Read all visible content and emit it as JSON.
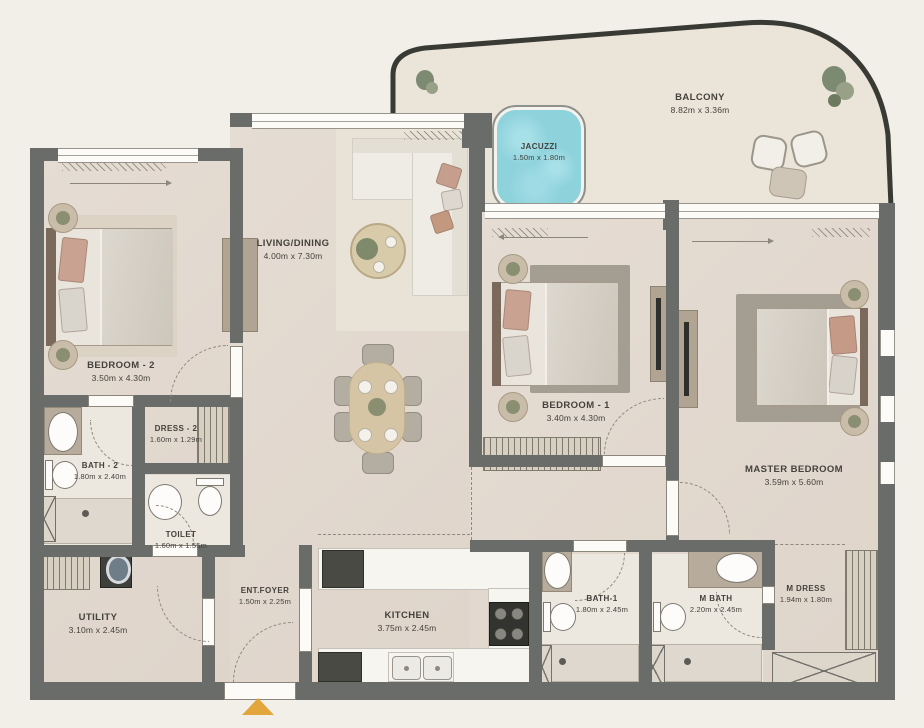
{
  "rooms": [
    {
      "id": "balcony",
      "name": "BALCONY",
      "dims": "8.82m x 3.36m"
    },
    {
      "id": "jacuzzi",
      "name": "JACUZZI",
      "dims": "1.50m x 1.80m"
    },
    {
      "id": "living-dining",
      "name": "LIVING/DINING",
      "dims": "4.00m x 7.30m"
    },
    {
      "id": "bedroom-2",
      "name": "BEDROOM - 2",
      "dims": "3.50m x 4.30m"
    },
    {
      "id": "bedroom-1",
      "name": "BEDROOM - 1",
      "dims": "3.40m x 4.30m"
    },
    {
      "id": "master-bedroom",
      "name": "MASTER BEDROOM",
      "dims": "3.59m x 5.60m"
    },
    {
      "id": "bath-2",
      "name": "BATH - 2",
      "dims": "1.80m x 2.40m"
    },
    {
      "id": "dress-2",
      "name": "DRESS - 2",
      "dims": "1.60m x 1.29m"
    },
    {
      "id": "toilet",
      "name": "TOILET",
      "dims": "1.60m x 1.55m"
    },
    {
      "id": "utility",
      "name": "UTILITY",
      "dims": "3.10m x 2.45m"
    },
    {
      "id": "ent-foyer",
      "name": "ENT.FOYER",
      "dims": "1.50m x 2.25m"
    },
    {
      "id": "kitchen",
      "name": "KITCHEN",
      "dims": "3.75m x 2.45m"
    },
    {
      "id": "bath-1",
      "name": "BATH-1",
      "dims": "1.80m x 2.45m"
    },
    {
      "id": "m-bath",
      "name": "M BATH",
      "dims": "2.20m x 2.45m"
    },
    {
      "id": "m-dress",
      "name": "M DRESS",
      "dims": "1.94m x 1.80m"
    }
  ],
  "colors": {
    "bg": "#f2efe9",
    "wall": "#6a6c69",
    "floor": "#e3dad1",
    "bathfloor": "#ece7df",
    "balcony": "#ebe5d9",
    "rugdark": "#a49d92",
    "ruglight": "#ddd3c5",
    "counter": "#f7f5f0",
    "wood": "#d6c5a4",
    "tan": "#b7ac9c",
    "water": "#8ed2dc",
    "accent": "#e2a63d",
    "ink": "#44423c"
  }
}
